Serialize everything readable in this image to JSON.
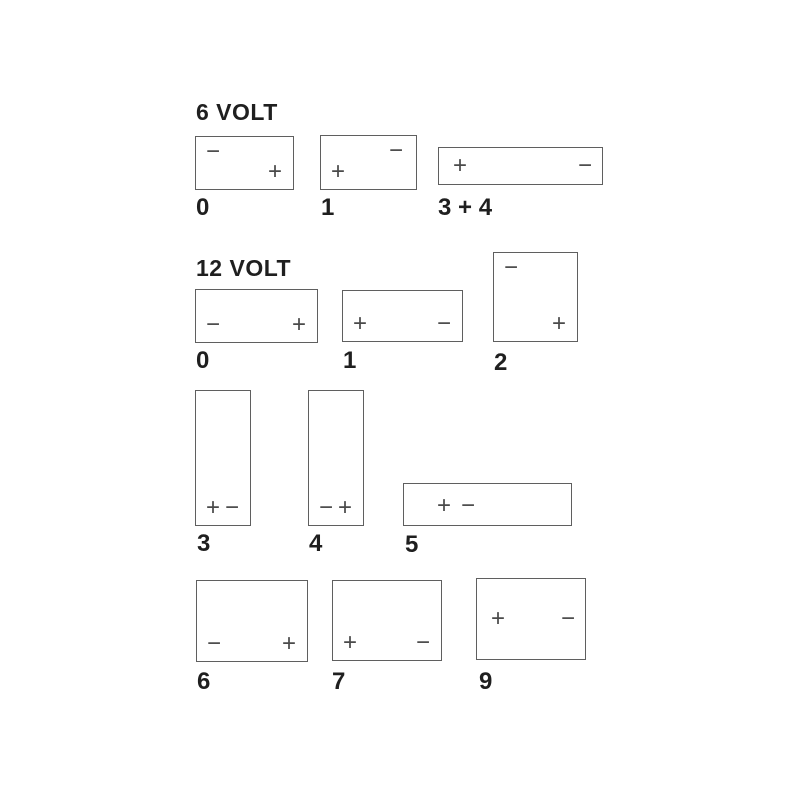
{
  "colors": {
    "background": "#ffffff",
    "line": "#5f5f5f",
    "text": "#1f1f1f",
    "terminal": "#4a4a4a"
  },
  "sections": [
    {
      "title": "6 VOLT",
      "batteries": [
        {
          "label": "0",
          "terminals": [
            {
              "name": "negative",
              "sign": "−",
              "pos": "top-left"
            },
            {
              "name": "positive",
              "sign": "+",
              "pos": "bottom-right"
            }
          ]
        },
        {
          "label": "1",
          "terminals": [
            {
              "name": "negative",
              "sign": "−",
              "pos": "top-right"
            },
            {
              "name": "positive",
              "sign": "+",
              "pos": "bottom-left"
            }
          ]
        },
        {
          "label": "3 + 4",
          "terminals": [
            {
              "name": "positive",
              "sign": "+",
              "pos": "mid-left"
            },
            {
              "name": "negative",
              "sign": "−",
              "pos": "mid-right"
            }
          ]
        }
      ]
    },
    {
      "title": "12 VOLT",
      "batteries": [
        {
          "label": "0",
          "terminals": [
            {
              "name": "negative",
              "sign": "−",
              "pos": "bottom-left"
            },
            {
              "name": "positive",
              "sign": "+",
              "pos": "bottom-right"
            }
          ]
        },
        {
          "label": "1",
          "terminals": [
            {
              "name": "positive",
              "sign": "+",
              "pos": "bottom-left"
            },
            {
              "name": "negative",
              "sign": "−",
              "pos": "bottom-right"
            }
          ]
        },
        {
          "label": "2",
          "terminals": [
            {
              "name": "negative",
              "sign": "−",
              "pos": "top-left"
            },
            {
              "name": "positive",
              "sign": "+",
              "pos": "bottom-right"
            }
          ]
        },
        {
          "label": "3",
          "terminals": [
            {
              "name": "positive",
              "sign": "+",
              "pos": "bottom-left"
            },
            {
              "name": "negative",
              "sign": "−",
              "pos": "bottom-right"
            }
          ]
        },
        {
          "label": "4",
          "terminals": [
            {
              "name": "negative",
              "sign": "−",
              "pos": "bottom-left"
            },
            {
              "name": "positive",
              "sign": "+",
              "pos": "bottom-right"
            }
          ]
        },
        {
          "label": "5",
          "terminals": [
            {
              "name": "positive",
              "sign": "+",
              "pos": "center-left-1"
            },
            {
              "name": "negative",
              "sign": "−",
              "pos": "center-left-2"
            }
          ]
        },
        {
          "label": "6",
          "terminals": [
            {
              "name": "negative",
              "sign": "−",
              "pos": "bottom-left"
            },
            {
              "name": "positive",
              "sign": "+",
              "pos": "bottom-right"
            }
          ]
        },
        {
          "label": "7",
          "terminals": [
            {
              "name": "positive",
              "sign": "+",
              "pos": "bottom-left"
            },
            {
              "name": "negative",
              "sign": "−",
              "pos": "bottom-right"
            }
          ]
        },
        {
          "label": "9",
          "terminals": [
            {
              "name": "positive",
              "sign": "+",
              "pos": "mid-left"
            },
            {
              "name": "negative",
              "sign": "−",
              "pos": "mid-right"
            }
          ]
        }
      ]
    }
  ]
}
